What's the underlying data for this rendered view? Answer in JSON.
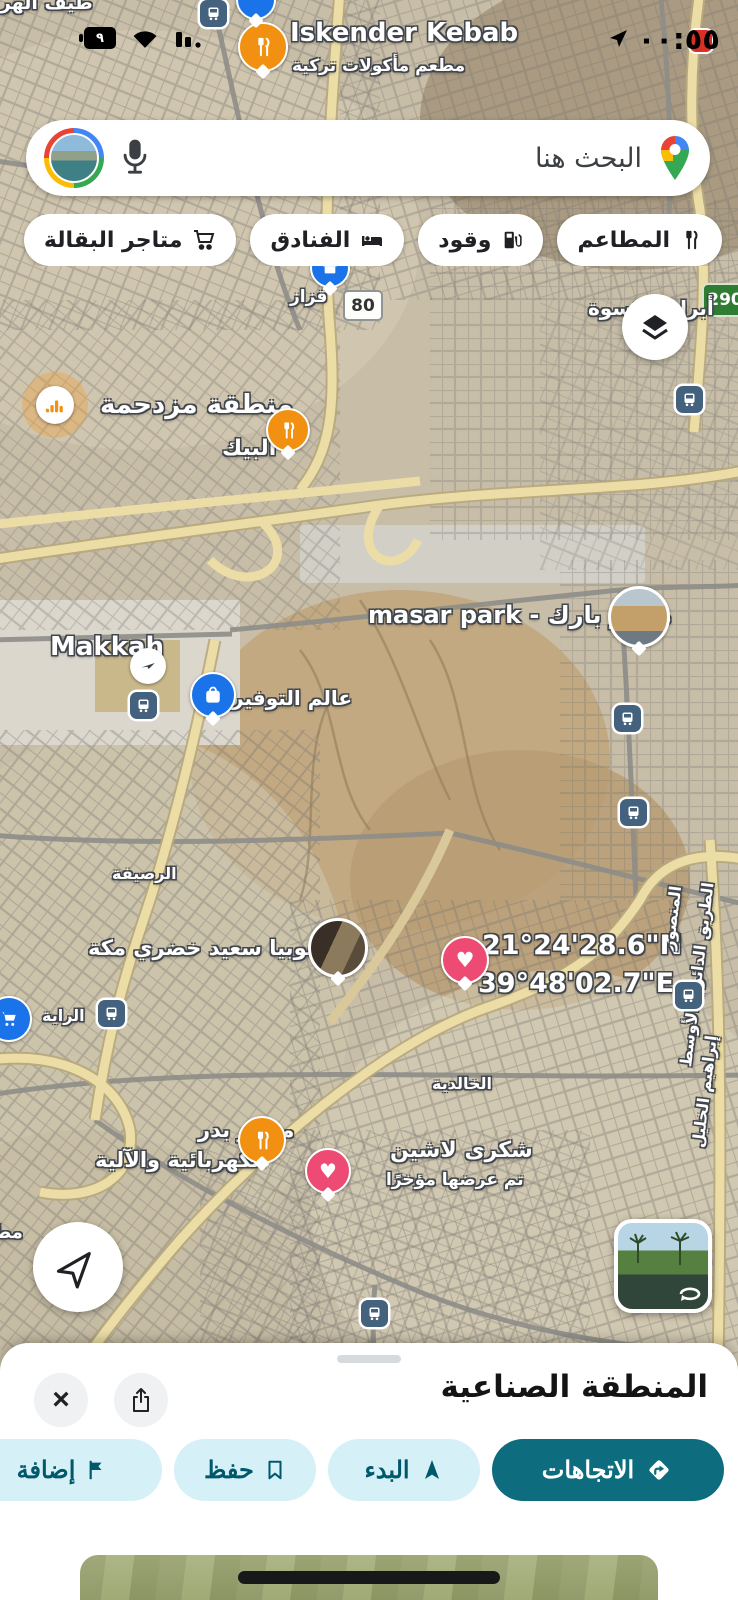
{
  "status_bar": {
    "time": "٠٠:٥٥",
    "battery_text": "٩"
  },
  "search": {
    "placeholder": "البحث هنا"
  },
  "chips": [
    {
      "label": "المطاعم"
    },
    {
      "label": "وقود"
    },
    {
      "label": "الفنادق"
    },
    {
      "label": "متاجر البقالة"
    }
  ],
  "map": {
    "route_badges": {
      "badge_80": "80",
      "badge_290": "290"
    },
    "labels": {
      "iskender_title": "Iskender Kebab",
      "iskender_sub": "مطعم مأكولات تركية",
      "tayf_alharam": "طيف الهرم",
      "qazaz": "قزاز",
      "abraj_alkiswah": "أبراج الكسوة",
      "busy_area": "منطقة مزدحمة",
      "albaik": "البيك",
      "makkah": "Makkah",
      "alam_altawfir": "عالم التوفير",
      "masar_park": "masar park - مسار بارك",
      "alrusayfah": "الرصيفة",
      "subya": "سوبيا سعيد خضري مكة",
      "coord_lat": "21°24'28.6\"N",
      "coord_lng": "39°48'02.7\"E",
      "almansur": "المنصور",
      "ring_road": "الطريق الدائري الأوسط",
      "ibrahim_alkhalil": "إبراهيم الخليل",
      "alraya": "الراية",
      "alkhalidiyyah": "الخالدية",
      "bakery_line1": "مخابز بدر",
      "bakery_line2": "الكهربائية والآلية",
      "shukri": "شكرى لاشين",
      "shukri_sub": "تم عرضها مؤخرًا",
      "partial_restaurant": "مطعم"
    }
  },
  "bottom_sheet": {
    "title": "المنطقة الصناعية",
    "directions_label": "الاتجاهات",
    "start_label": "البدء",
    "save_label": "حفظ",
    "add_label": "إضافة"
  },
  "colors": {
    "accent_teal": "#0d6c7e",
    "action_chip_bg": "#d6f0f7",
    "action_chip_text": "#00586b",
    "pin_orange": "#f29111",
    "pin_blue": "#1a73e8",
    "heart_pink": "#ee4b74"
  }
}
